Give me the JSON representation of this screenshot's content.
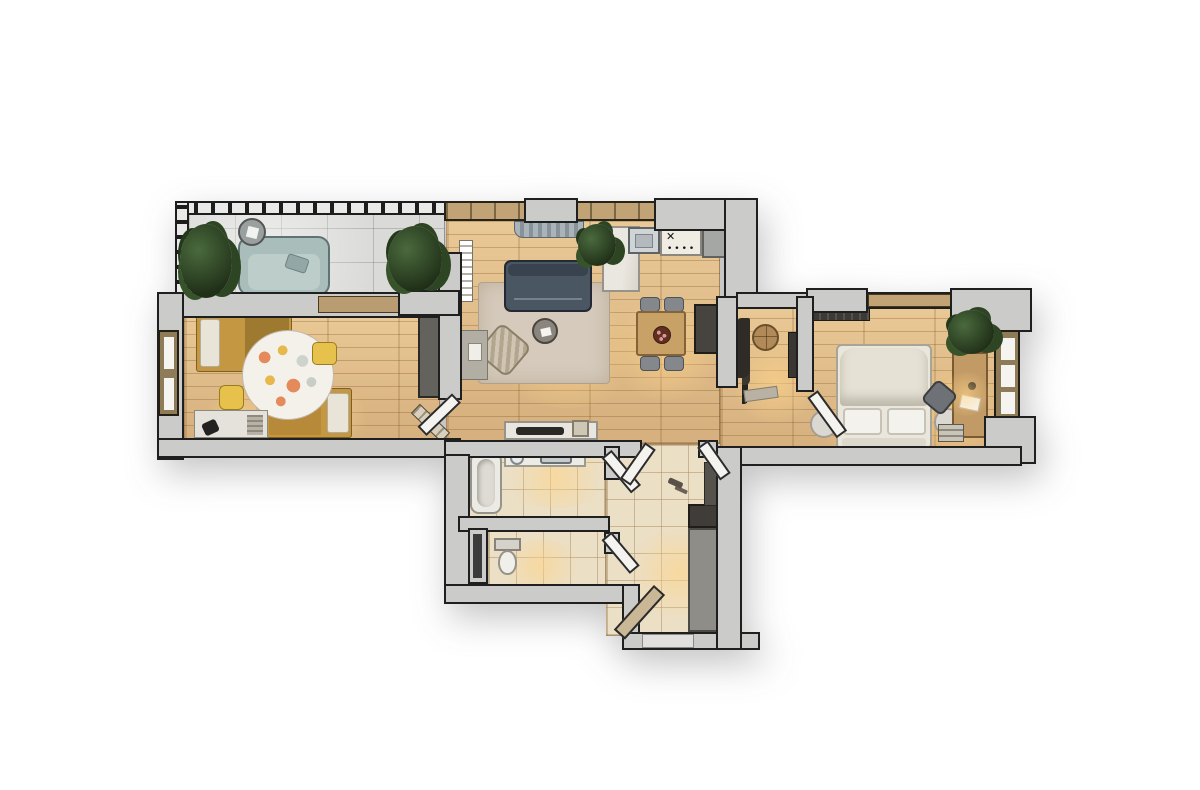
{
  "scene": {
    "kind": "apartment floor plan, top-down 3D render",
    "background_color": "#ffffff",
    "visible_text": "none"
  },
  "palette": {
    "wall": "#cbcbca",
    "wall_outline": "#1f1f1f",
    "wood_floor": "#e0bd8d",
    "balcony_tile": "#dadad8",
    "bath_tile": "#ebdfc6",
    "living_rug": "#d5cabc",
    "kids_rug": "#f4f1ea",
    "sofa_dark": "#4b5663",
    "loveseat_teal": "#a9bdbb",
    "kids_bed_mustard": "#c49742",
    "master_bed_cream": "#eae6db",
    "counter_gray": "#a4a7a3",
    "marble_white": "#eae7e0",
    "wood_furniture": "#c7a166",
    "dark_cabinet": "#474440",
    "plant_green": "#2d4522",
    "warm_light": "#ffd487"
  },
  "rooms": [
    {
      "name": "Balcony loggia",
      "floor": "gray tile",
      "furniture": [
        "teal loveseat",
        "round side table",
        "potted palm left",
        "potted palm right",
        "pergola slat roof",
        "slatted railing"
      ]
    },
    {
      "name": "Kids bedroom",
      "floor": "wood planks",
      "furniture": [
        "mustard single bed top",
        "mustard single bed bottom",
        "round spotted rug",
        "yellow pouf",
        "yellow desk chair",
        "desk with black lamp",
        "dark wardrobe",
        "leaning ladder rack",
        "window on left wall"
      ]
    },
    {
      "name": "Living room",
      "floor": "wood planks",
      "furniture": [
        "dark gray sofa",
        "beige area rug",
        "round coffee table",
        "striped armchair",
        "white bookshelf",
        "media stand",
        "curtains on top window",
        "potted plant"
      ]
    },
    {
      "name": "Kitchen",
      "floor": "wood planks",
      "furniture": [
        "steel sink",
        "white counter with 4-burner hob",
        "gray corner counter",
        "tall marble cabinet column"
      ]
    },
    {
      "name": "Dining area",
      "floor": "wood planks",
      "furniture": [
        "wooden dining table",
        "four gray chairs",
        "round centerpiece plate",
        "tall dark cabinet"
      ]
    },
    {
      "name": "Hallway",
      "floor": "wood planks",
      "furniture": [
        "console sideboard",
        "black soundbar",
        "small picture frame",
        "open interior doors"
      ]
    },
    {
      "name": "Master bedroom",
      "floor": "wood planks",
      "furniture": [
        "cream double bed with two pillows",
        "two round nightstands",
        "dark wardrobe strip",
        "wooden desk",
        "office chair",
        "desk lamp with papers",
        "stack of books",
        "potted plant",
        "narrow window right wall"
      ]
    },
    {
      "name": "Bedroom corridor",
      "floor": "wood planks",
      "furniture": [
        "coat rack with clothes",
        "round wooden wall mirror",
        "slim shelf rack",
        "doormat"
      ]
    },
    {
      "name": "Bathroom",
      "floor": "beige tile",
      "furniture": [
        "bathtub",
        "vanity counter with steel sink",
        "round accessory",
        "open door"
      ]
    },
    {
      "name": "WC",
      "floor": "beige tile",
      "furniture": [
        "toilet",
        "service duct shaft",
        "open door"
      ]
    },
    {
      "name": "Entry hall",
      "floor": "beige tile",
      "furniture": [
        "gray wardrobe cabinet",
        "dark upper box",
        "slim panel",
        "front door ajar",
        "double interior doors"
      ]
    }
  ],
  "stove": {
    "burner_glyph": "✕",
    "knob_dots": "••••"
  }
}
